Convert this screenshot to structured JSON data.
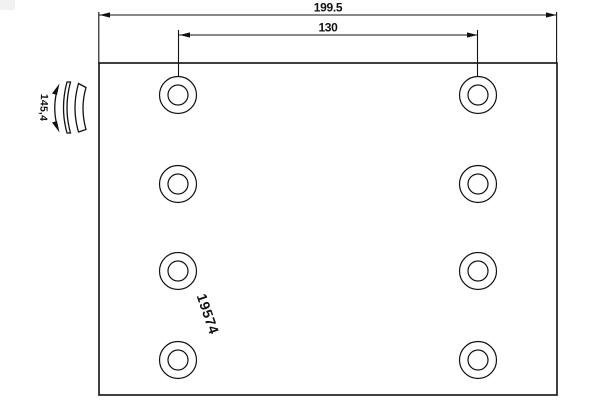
{
  "drawing": {
    "part_number": "19574",
    "dimensions": {
      "overall_width": "199.5",
      "hole_span": "130",
      "curvature": "145,4"
    },
    "colors": {
      "line": "#111111",
      "background": "#ffffff"
    },
    "holes": {
      "columns_x": [
        178,
        478
      ],
      "rows_y": [
        95,
        184,
        271,
        360
      ],
      "outer_r": 18.5,
      "inner_r": 10
    }
  }
}
